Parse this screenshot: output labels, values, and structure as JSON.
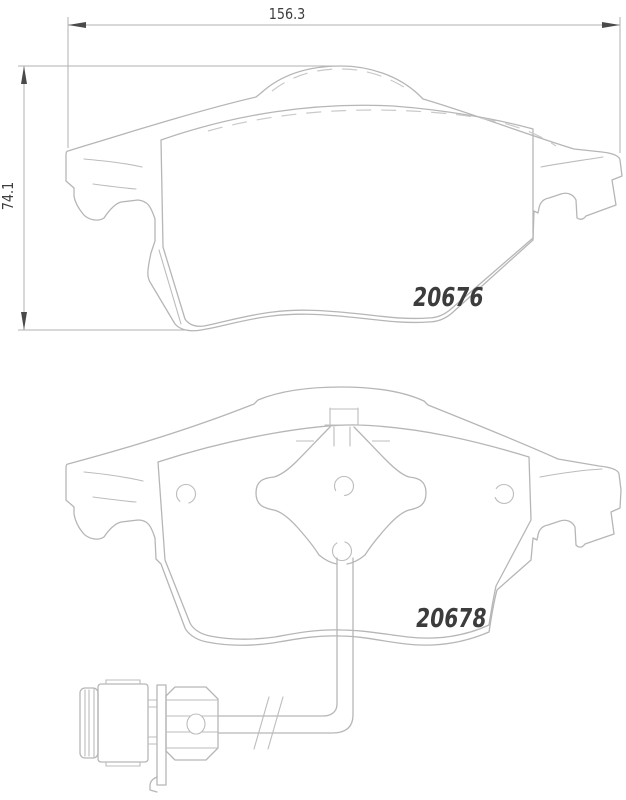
{
  "diagram": {
    "title": "Disc brake pad set technical drawing",
    "dimension_width_mm": "156.3",
    "dimension_height_mm": "74.1",
    "pads": [
      {
        "view": "outer pad front view",
        "part_number": "20676"
      },
      {
        "view": "inner pad with wear sensor",
        "part_number": "20678"
      }
    ],
    "colors": {
      "background": "#ffffff",
      "outline": "#b6b6b6",
      "hidden_line": "#c9c9c9",
      "text": "#3d3d3d",
      "arrow": "#4a4a4a"
    }
  }
}
